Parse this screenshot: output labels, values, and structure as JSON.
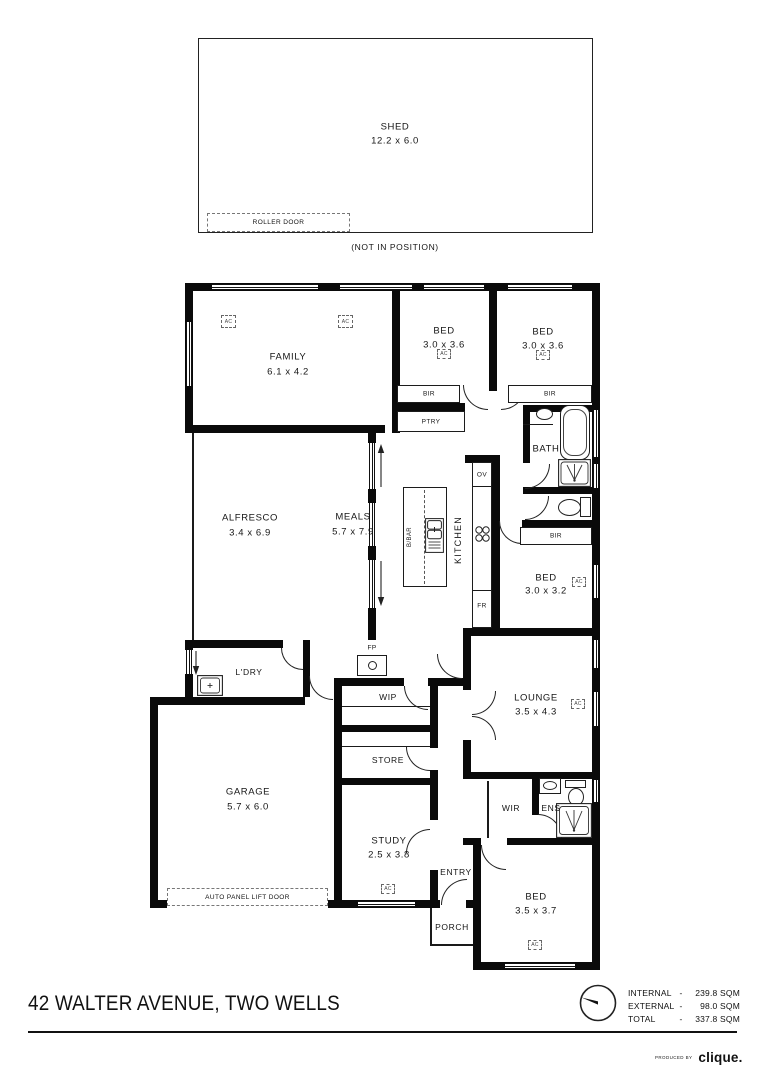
{
  "shed": {
    "name": "SHED",
    "dims": "12.2 x 6.0",
    "roller_door": "ROLLER DOOR",
    "note": "(NOT IN POSITION)"
  },
  "rooms": {
    "family": {
      "name": "FAMILY",
      "dims": "6.1 x 4.2"
    },
    "bed1": {
      "name": "BED",
      "dims": "3.0 x 3.6"
    },
    "bed2": {
      "name": "BED",
      "dims": "3.0 x 3.6"
    },
    "alfresco": {
      "name": "ALFRESCO",
      "dims": "3.4 x 6.9"
    },
    "meals": {
      "name": "MEALS",
      "dims": "5.7 x 7.9"
    },
    "kitchen": {
      "name": "KITCHEN"
    },
    "bath": {
      "name": "BATH"
    },
    "bed3": {
      "name": "BED",
      "dims": "3.0 x 3.2"
    },
    "lounge": {
      "name": "LOUNGE",
      "dims": "3.5 x 4.3"
    },
    "ldry": {
      "name": "L'DRY"
    },
    "garage": {
      "name": "GARAGE",
      "dims": "5.7 x 6.0"
    },
    "wip": {
      "name": "WIP"
    },
    "store": {
      "name": "STORE"
    },
    "study": {
      "name": "STUDY",
      "dims": "2.5 x 3.8"
    },
    "entry": {
      "name": "ENTRY"
    },
    "porch": {
      "name": "PORCH"
    },
    "wir": {
      "name": "WIR"
    },
    "ens": {
      "name": "ENS"
    },
    "bed4": {
      "name": "BED",
      "dims": "3.5 x 3.7"
    }
  },
  "fixtures": {
    "bir": "BIR",
    "ptry": "PTRY",
    "oven": "OV",
    "fridge": "FR",
    "bbar": "B/BAR",
    "fireplace": "FP",
    "ac": "AC",
    "auto_door": "AUTO PANEL LIFT DOOR"
  },
  "footer": {
    "address": "42 WALTER AVENUE, TWO WELLS",
    "areas": [
      {
        "label": "INTERNAL",
        "sep": "-",
        "value": "239.8 SQM"
      },
      {
        "label": "EXTERNAL",
        "sep": "-",
        "value": "98.0 SQM"
      },
      {
        "label": "TOTAL",
        "sep": "-",
        "value": "337.8 SQM"
      }
    ],
    "produced_by": "PRODUCED BY",
    "brand": "clique."
  }
}
